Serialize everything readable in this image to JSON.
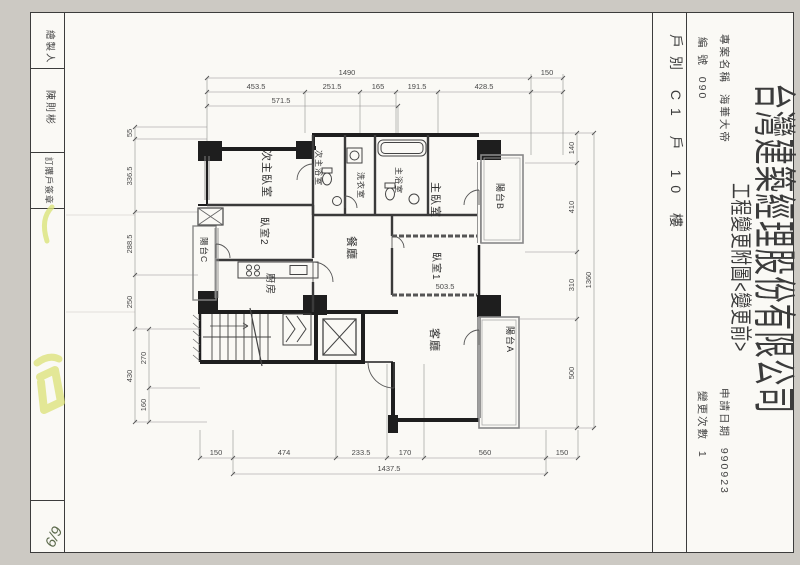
{
  "sheet": {
    "left_block": {
      "rows": [
        {
          "label": "繪製人"
        },
        {
          "label": "陳則彬"
        },
        {
          "label": "訂購戶簽章"
        }
      ],
      "note": "6/9"
    },
    "right_block": {
      "unit": "戶別 C1 戶 10 樓",
      "project_label": "專案名稱",
      "project_value": "海華大帝",
      "no_label": "編 號",
      "no_value": "090",
      "company": "台灣建築經理股份有限公司",
      "subtitle": "工程變更附圖<變更前>",
      "date_label": "申請日期",
      "date_value": "990923",
      "rev_label": "變更次數",
      "rev_value": "1"
    }
  },
  "plan": {
    "rooms": [
      "次主臥室",
      "次主浴室",
      "洗衣室",
      "主浴室",
      "主臥室",
      "陽台B",
      "臥室2",
      "陽台C",
      "廚房",
      "餐廳",
      "臥室1",
      "客廳",
      "陽台A"
    ],
    "dims": {
      "top_total": "1490",
      "top_right": "150",
      "top_row": [
        "453.5",
        "251.5",
        "165",
        "191.5",
        "428.5"
      ],
      "top_sub": "571.5",
      "left_outer": [
        "55",
        "336.5",
        "288.5",
        "250",
        "430"
      ],
      "left_inner": [
        "270",
        "160"
      ],
      "right_inner": [
        "140",
        "410",
        "310",
        "500"
      ],
      "right_total": "1360",
      "bottom_row": [
        "150",
        "474",
        "233.5",
        "170",
        "560",
        "150"
      ],
      "bottom_total": "1437.5",
      "inner": "503.5"
    }
  }
}
